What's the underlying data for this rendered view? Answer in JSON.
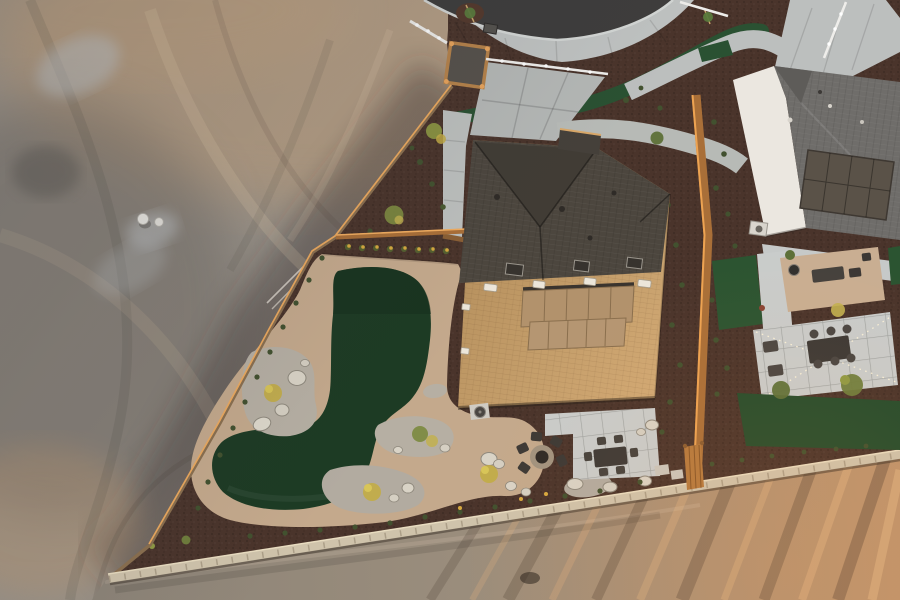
{
  "scene": {
    "type": "aerial-drone-photo",
    "time_of_day": "sunset",
    "subject": "new-construction desert home backyard with artificial turf, gravel landscaping, fire pit and paver patio; vacant graded dirt lot to the west; neighboring white house with solar roof to the east; curved street and sidewalks to the north; graded dirt road to the south"
  },
  "colors": {
    "dirt_base": "#9b948b",
    "dirt_warm": "#d3a97c",
    "dirt_shadow": "#5f5a55",
    "dirt_pale": "#c6ccd0",
    "road_left": "#8d8478",
    "road_right": "#bf946c",
    "asphalt": "#3e3d3c",
    "concrete": "#bfc2c1",
    "concrete_dim": "#b4b7b5",
    "mulch": "#4a342b",
    "mulch_dark": "#3f2d25",
    "turf": "#1d3b24",
    "turf_strip": "#2a5132",
    "turf_right": "#2b5431",
    "path_dg": "#c4a98c",
    "dg_patio": "#c9ae92",
    "gravel": "#b6afa3",
    "boulder": "#d9d3c6",
    "roof_dark": "#4c463e",
    "roof_valley": "#413c35",
    "roof_lit": "#c59d6b",
    "solar_main": "#b2926c",
    "roof_right": "#6f6d6a",
    "gable_right": "#5e5c59",
    "solar_right": "#5a5248",
    "wall_white": "#ebe7e0",
    "paver": "#c9cccb",
    "fence_wood": "#a96f38",
    "fence_glow": "#f0ac5f",
    "block_wall": "#cfc3ab",
    "furniture": "#3c3936",
    "shrub": "#4a5a31",
    "shrub_yellow": "#c2ac45",
    "flower_yellow": "#d7a93f",
    "rock_white": "#eceae4",
    "white_fence": "#eeedea",
    "sapling": "#5a7a3c",
    "ac_unit": "#d9d5cd",
    "chimney": "#45403a"
  },
  "objects": {
    "fire_pit_chairs": 5,
    "dining_chairs_main": 6,
    "dining_chairs_right": 6,
    "boulders_west_bed": 4,
    "saplings_parkway": 2,
    "string_light_strands": 2,
    "houses": 2
  }
}
